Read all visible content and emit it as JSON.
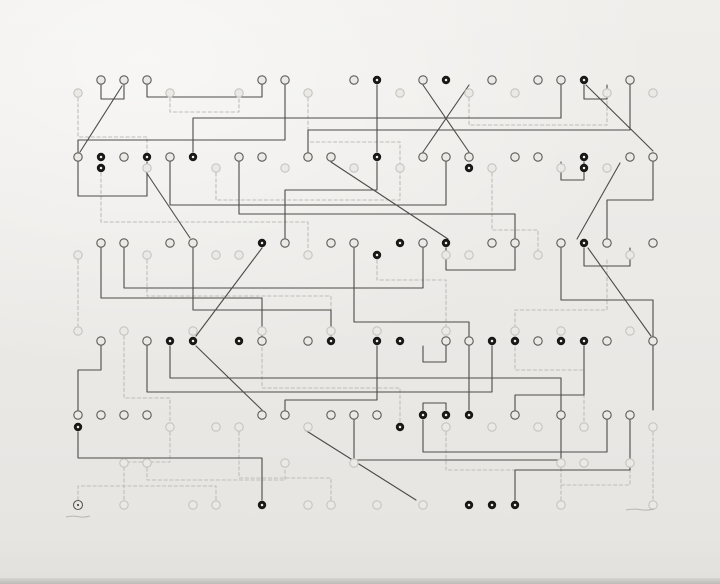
{
  "artwork": {
    "canvas": {
      "width": 720,
      "height": 584
    },
    "palette": {
      "paper": "#ebe9e6",
      "edge_shadow": "#cfccc8",
      "dark_line": "#4c4b49",
      "dark_ring": "#5c5a57",
      "light_line": "#bfbdb8",
      "light_ring": "#c6c4bf",
      "black_dot": "#181816",
      "dot_center": "#f1efec",
      "pencil": "#a8a5a0"
    },
    "grid": {
      "x0": 78,
      "dx": 23
    },
    "node_radius": 4.2,
    "rows": [
      {
        "id": "row-1-dark",
        "kind": "dark",
        "y": 80,
        "nodes": [
          [
            1,
            0
          ],
          [
            2,
            0
          ],
          [
            3,
            0
          ],
          [
            8,
            0
          ],
          [
            9,
            0
          ],
          [
            12,
            0
          ],
          [
            13,
            1
          ],
          [
            15,
            0
          ],
          [
            16,
            1
          ],
          [
            18,
            0
          ],
          [
            20,
            0
          ],
          [
            21,
            0
          ],
          [
            22,
            1
          ],
          [
            24,
            0
          ]
        ]
      },
      {
        "id": "row-1-light",
        "kind": "light",
        "y": 93,
        "nodes": [
          [
            0,
            0
          ],
          [
            4,
            0
          ],
          [
            7,
            0
          ],
          [
            10,
            0
          ],
          [
            14,
            0
          ],
          [
            17,
            0
          ],
          [
            19,
            0
          ],
          [
            23,
            0
          ],
          [
            25,
            0
          ]
        ]
      },
      {
        "id": "row-2-dark",
        "kind": "dark",
        "y": 157,
        "nodes": [
          [
            0,
            0
          ],
          [
            1,
            1
          ],
          [
            2,
            0
          ],
          [
            3,
            1
          ],
          [
            4,
            0
          ],
          [
            5,
            1
          ],
          [
            7,
            0
          ],
          [
            8,
            0
          ],
          [
            10,
            0
          ],
          [
            11,
            0
          ],
          [
            13,
            1
          ],
          [
            15,
            0
          ],
          [
            16,
            0
          ],
          [
            17,
            0
          ],
          [
            19,
            0
          ],
          [
            20,
            0
          ],
          [
            22,
            1
          ],
          [
            24,
            0
          ],
          [
            25,
            0
          ]
        ]
      },
      {
        "id": "row-2-light",
        "kind": "light",
        "y": 168,
        "nodes": [
          [
            1,
            1
          ],
          [
            3,
            0
          ],
          [
            6,
            0
          ],
          [
            9,
            0
          ],
          [
            12,
            0
          ],
          [
            14,
            0
          ],
          [
            17,
            1
          ],
          [
            18,
            0
          ],
          [
            21,
            0
          ],
          [
            22,
            1
          ],
          [
            23,
            0
          ]
        ]
      },
      {
        "id": "row-3-dark",
        "kind": "dark",
        "y": 243,
        "nodes": [
          [
            1,
            0
          ],
          [
            2,
            0
          ],
          [
            4,
            0
          ],
          [
            5,
            0
          ],
          [
            8,
            1
          ],
          [
            9,
            0
          ],
          [
            11,
            0
          ],
          [
            12,
            0
          ],
          [
            14,
            1
          ],
          [
            15,
            0
          ],
          [
            16,
            1
          ],
          [
            18,
            0
          ],
          [
            19,
            0
          ],
          [
            21,
            0
          ],
          [
            22,
            1
          ],
          [
            23,
            0
          ],
          [
            25,
            0
          ]
        ]
      },
      {
        "id": "row-3-light",
        "kind": "light",
        "y": 255,
        "nodes": [
          [
            0,
            0
          ],
          [
            3,
            0
          ],
          [
            6,
            0
          ],
          [
            7,
            0
          ],
          [
            10,
            0
          ],
          [
            13,
            1
          ],
          [
            16,
            0
          ],
          [
            17,
            0
          ],
          [
            20,
            0
          ],
          [
            24,
            0
          ]
        ]
      },
      {
        "id": "row-4-light",
        "kind": "light",
        "y": 331,
        "nodes": [
          [
            0,
            0
          ],
          [
            2,
            0
          ],
          [
            5,
            0
          ],
          [
            8,
            0
          ],
          [
            11,
            0
          ],
          [
            13,
            0
          ],
          [
            16,
            0
          ],
          [
            19,
            0
          ],
          [
            21,
            0
          ],
          [
            24,
            0
          ]
        ]
      },
      {
        "id": "row-4-dark",
        "kind": "dark",
        "y": 341,
        "nodes": [
          [
            1,
            0
          ],
          [
            3,
            0
          ],
          [
            4,
            1
          ],
          [
            5,
            1
          ],
          [
            7,
            1
          ],
          [
            8,
            0
          ],
          [
            10,
            0
          ],
          [
            11,
            1
          ],
          [
            13,
            1
          ],
          [
            14,
            1
          ],
          [
            16,
            0
          ],
          [
            17,
            0
          ],
          [
            18,
            1
          ],
          [
            19,
            1
          ],
          [
            20,
            0
          ],
          [
            21,
            1
          ],
          [
            22,
            1
          ],
          [
            23,
            0
          ],
          [
            25,
            0
          ]
        ]
      },
      {
        "id": "row-5-dark",
        "kind": "dark",
        "y": 415,
        "nodes": [
          [
            0,
            0
          ],
          [
            1,
            0
          ],
          [
            2,
            0
          ],
          [
            3,
            0
          ],
          [
            8,
            0
          ],
          [
            9,
            0
          ],
          [
            11,
            0
          ],
          [
            12,
            0
          ],
          [
            13,
            0
          ],
          [
            15,
            1
          ],
          [
            16,
            1
          ],
          [
            17,
            1
          ],
          [
            19,
            0
          ],
          [
            21,
            0
          ],
          [
            23,
            0
          ],
          [
            24,
            0
          ]
        ]
      },
      {
        "id": "row-5-light",
        "kind": "light",
        "y": 427,
        "nodes": [
          [
            0,
            1
          ],
          [
            4,
            0
          ],
          [
            6,
            0
          ],
          [
            7,
            0
          ],
          [
            10,
            0
          ],
          [
            14,
            1
          ],
          [
            16,
            0
          ],
          [
            18,
            0
          ],
          [
            20,
            0
          ],
          [
            22,
            0
          ],
          [
            25,
            0
          ]
        ]
      },
      {
        "id": "row-6-light",
        "kind": "light",
        "y": 463,
        "nodes": [
          [
            2,
            0
          ],
          [
            3,
            0
          ],
          [
            9,
            0
          ],
          [
            12,
            0
          ],
          [
            21,
            0
          ],
          [
            22,
            0
          ],
          [
            24,
            0
          ]
        ]
      },
      {
        "id": "row-7-light",
        "kind": "light",
        "y": 505,
        "nodes": [
          [
            2,
            0
          ],
          [
            5,
            0
          ],
          [
            6,
            0
          ],
          [
            8,
            1
          ],
          [
            10,
            0
          ],
          [
            11,
            0
          ],
          [
            13,
            0
          ],
          [
            15,
            0
          ],
          [
            17,
            1
          ],
          [
            18,
            1
          ],
          [
            19,
            1
          ],
          [
            21,
            0
          ],
          [
            25,
            0
          ]
        ]
      }
    ],
    "edges": {
      "dark": [
        [
          101,
          85,
          101,
          99,
          124,
          99,
          124,
          85
        ],
        [
          122,
          86,
          80,
          152
        ],
        [
          147,
          85,
          147,
          97,
          262,
          97,
          262,
          85
        ],
        [
          193,
          152,
          193,
          118,
          561,
          118,
          561,
          85
        ],
        [
          377,
          85,
          377,
          152
        ],
        [
          423,
          85,
          469,
          152
        ],
        [
          469,
          85,
          423,
          152
        ],
        [
          584,
          85,
          584,
          99,
          607,
          99,
          607,
          85
        ],
        [
          586,
          85,
          653,
          151
        ],
        [
          630,
          85,
          630,
          130,
          308,
          130,
          308,
          152
        ],
        [
          285,
          85,
          285,
          140,
          78,
          140,
          78,
          152
        ],
        [
          78,
          162,
          78,
          196,
          147,
          196,
          147,
          162
        ],
        [
          170,
          162,
          170,
          205,
          446,
          205,
          446,
          162
        ],
        [
          239,
          162,
          239,
          214,
          515,
          214,
          515,
          238
        ],
        [
          146,
          172,
          190,
          238
        ],
        [
          331,
          162,
          448,
          239
        ],
        [
          561,
          162,
          561,
          180,
          584,
          180,
          584,
          162
        ],
        [
          620,
          163,
          577,
          239
        ],
        [
          653,
          162,
          653,
          200,
          607,
          200,
          607,
          238
        ],
        [
          377,
          162,
          377,
          190,
          285,
          190,
          285,
          238
        ],
        [
          101,
          248,
          101,
          298,
          262,
          298,
          262,
          336
        ],
        [
          124,
          248,
          124,
          288,
          423,
          288,
          423,
          248
        ],
        [
          193,
          248,
          193,
          310,
          331,
          310,
          331,
          336
        ],
        [
          262,
          248,
          196,
          336
        ],
        [
          446,
          248,
          446,
          270,
          515,
          270,
          515,
          248
        ],
        [
          561,
          248,
          561,
          300,
          653,
          300,
          653,
          336
        ],
        [
          584,
          248,
          584,
          266,
          630,
          266,
          630,
          248
        ],
        [
          354,
          248,
          354,
          322,
          469,
          322,
          469,
          336
        ],
        [
          588,
          248,
          651,
          336
        ],
        [
          101,
          346,
          101,
          370,
          78,
          370,
          78,
          410
        ],
        [
          147,
          346,
          147,
          392,
          492,
          392,
          492,
          346
        ],
        [
          170,
          346,
          170,
          378,
          561,
          378,
          561,
          410
        ],
        [
          377,
          346,
          377,
          400,
          285,
          400,
          285,
          410
        ],
        [
          196,
          346,
          262,
          410
        ],
        [
          423,
          346,
          423,
          362,
          446,
          362,
          446,
          346
        ],
        [
          584,
          346,
          584,
          395,
          515,
          395,
          515,
          410
        ],
        [
          653,
          346,
          653,
          410
        ],
        [
          469,
          346,
          469,
          410
        ],
        [
          423,
          410,
          423,
          403,
          446,
          403,
          446,
          410
        ],
        [
          78,
          432,
          78,
          458,
          262,
          458,
          262,
          500
        ],
        [
          423,
          420,
          423,
          452,
          607,
          452,
          607,
          420
        ],
        [
          354,
          420,
          354,
          460,
          561,
          460,
          561,
          420
        ],
        [
          305,
          430,
          416,
          500
        ],
        [
          630,
          420,
          630,
          470,
          515,
          470,
          515,
          500
        ]
      ],
      "light": [
        [
          78,
          98,
          78,
          137,
          147,
          137,
          147,
          163
        ],
        [
          170,
          98,
          170,
          112,
          239,
          112,
          239,
          98
        ],
        [
          308,
          98,
          308,
          142,
          400,
          142,
          400,
          163
        ],
        [
          469,
          98,
          469,
          125,
          607,
          125,
          607,
          98
        ],
        [
          101,
          173,
          101,
          222,
          308,
          222,
          308,
          250
        ],
        [
          216,
          173,
          216,
          200,
          400,
          200,
          400,
          173
        ],
        [
          492,
          173,
          492,
          230,
          538,
          230,
          538,
          250
        ],
        [
          147,
          260,
          147,
          296,
          331,
          296,
          331,
          326
        ],
        [
          377,
          260,
          377,
          280,
          446,
          280,
          446,
          326
        ],
        [
          607,
          260,
          607,
          310,
          515,
          310,
          515,
          326
        ],
        [
          78,
          260,
          78,
          326
        ],
        [
          124,
          336,
          124,
          398,
          170,
          398,
          170,
          422
        ],
        [
          262,
          336,
          262,
          388,
          400,
          388,
          400,
          422
        ],
        [
          515,
          336,
          515,
          370,
          584,
          370,
          584,
          422
        ],
        [
          170,
          432,
          170,
          462,
          124,
          462,
          124,
          500
        ],
        [
          239,
          432,
          239,
          478,
          331,
          478,
          331,
          500
        ],
        [
          446,
          432,
          446,
          470,
          561,
          470,
          561,
          500
        ],
        [
          653,
          432,
          653,
          500
        ],
        [
          147,
          468,
          147,
          480,
          285,
          480,
          285,
          468
        ],
        [
          561,
          468,
          561,
          485,
          630,
          485,
          630,
          468
        ],
        [
          78,
          500,
          78,
          486,
          216,
          486,
          216,
          500
        ]
      ]
    },
    "chop_mark": {
      "x": 78,
      "y": 505,
      "radius": 4.5
    },
    "inscriptions": [
      {
        "id": "pencil-inscription-left",
        "x": 66,
        "y": 517,
        "width": 24
      },
      {
        "id": "pencil-inscription-right",
        "x": 626,
        "y": 510,
        "width": 28
      }
    ]
  }
}
